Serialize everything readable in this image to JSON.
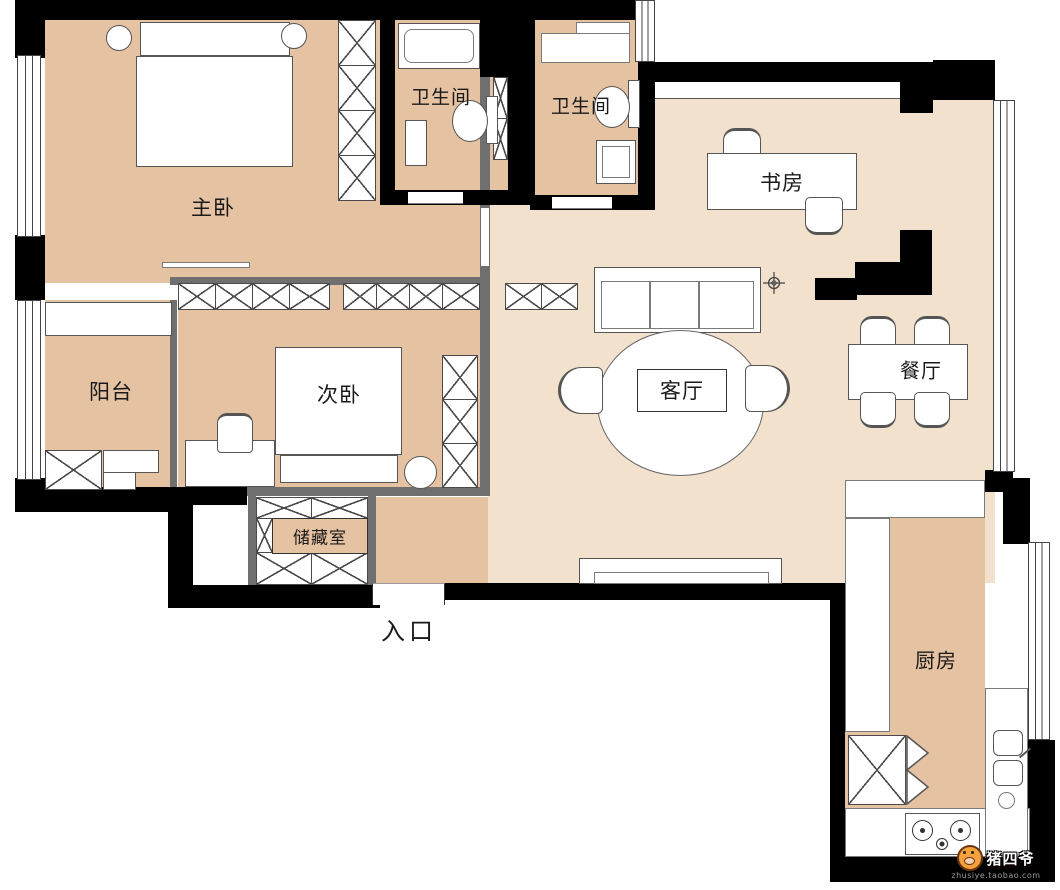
{
  "plan": {
    "rooms": {
      "master_bedroom": {
        "label": "主卧"
      },
      "bathroom_1": {
        "label": "卫生间"
      },
      "bathroom_2": {
        "label": "卫生间"
      },
      "study": {
        "label": "书房"
      },
      "balcony": {
        "label": "阳台"
      },
      "second_bedroom": {
        "label": "次卧"
      },
      "storage": {
        "label": "储藏室"
      },
      "living_room": {
        "label": "客厅"
      },
      "dining_room": {
        "label": "餐厅"
      },
      "kitchen": {
        "label": "厨房"
      },
      "entrance": {
        "label": "入口"
      }
    },
    "colors": {
      "wall": "#000000",
      "inner_wall": "#6f6f6f",
      "floor_dark": "#e5c2a1",
      "floor_light": "#f2e1cd",
      "line": "#555555",
      "label_text": "#1a1a1a"
    },
    "watermark": {
      "brand": "猪四爷",
      "url": "zhusiye.taobao.com"
    }
  }
}
